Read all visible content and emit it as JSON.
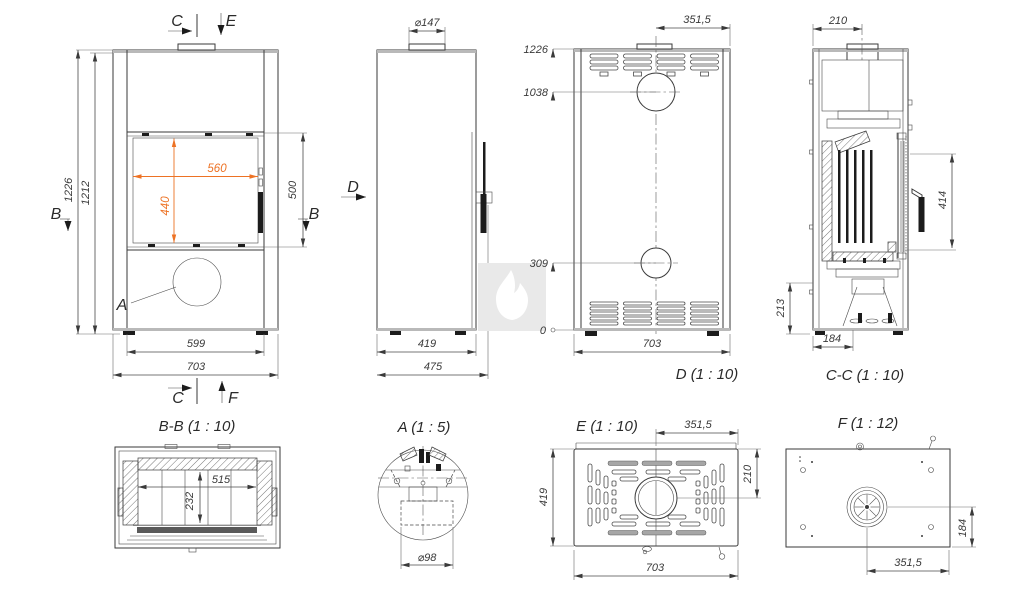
{
  "document": {
    "type": "technical-drawing",
    "subject": "fireplace-stove multiview dimensional drawing"
  },
  "colors": {
    "line": "#3A3A3A",
    "accent_dim": "#ED7224",
    "watermark_bg": "#E9E9E9",
    "watermark_flame": "#FFFFFF"
  },
  "views": {
    "front": {
      "marks": {
        "c_top": "C",
        "e": "E",
        "b_left": "B",
        "b_right": "B",
        "a": "A",
        "c_bottom": "C",
        "f": "F"
      },
      "dims": {
        "total_height": "1226",
        "body_height": "1212",
        "glass_width": "560",
        "glass_height": "440",
        "door_height": "500",
        "base_width": "599",
        "total_width": "703"
      }
    },
    "side": {
      "marks": {
        "d": "D"
      },
      "dims": {
        "flue_diameter": "⌀147",
        "body_depth": "419",
        "total_depth": "475"
      }
    },
    "rear": {
      "title": "D (1 : 10)",
      "dims": {
        "level_top": "1226",
        "level_flue": "1038",
        "level_intake": "309",
        "level_zero": "0",
        "flue_offset": "351,5",
        "width": "703"
      }
    },
    "section_cc": {
      "title": "C-C (1 : 10)",
      "dims": {
        "flue_to_back": "210",
        "glass_height": "414",
        "base_height": "213",
        "intake_to_back": "184"
      }
    },
    "section_bb": {
      "title": "B-B (1 : 10)",
      "dims": {
        "chamber_width": "515",
        "chamber_depth": "232"
      }
    },
    "detail_a": {
      "title": "A (1 : 5)",
      "dims": {
        "hole_diameter": "⌀98"
      }
    },
    "top_e": {
      "title": "E (1 : 10)",
      "dims": {
        "flue_offset": "351,5",
        "flue_to_back": "210",
        "depth": "419",
        "width": "703"
      }
    },
    "bottom_f": {
      "title": "F (1 : 12)",
      "dims": {
        "fan_to_front": "184",
        "fan_offset": "351,5"
      }
    }
  }
}
